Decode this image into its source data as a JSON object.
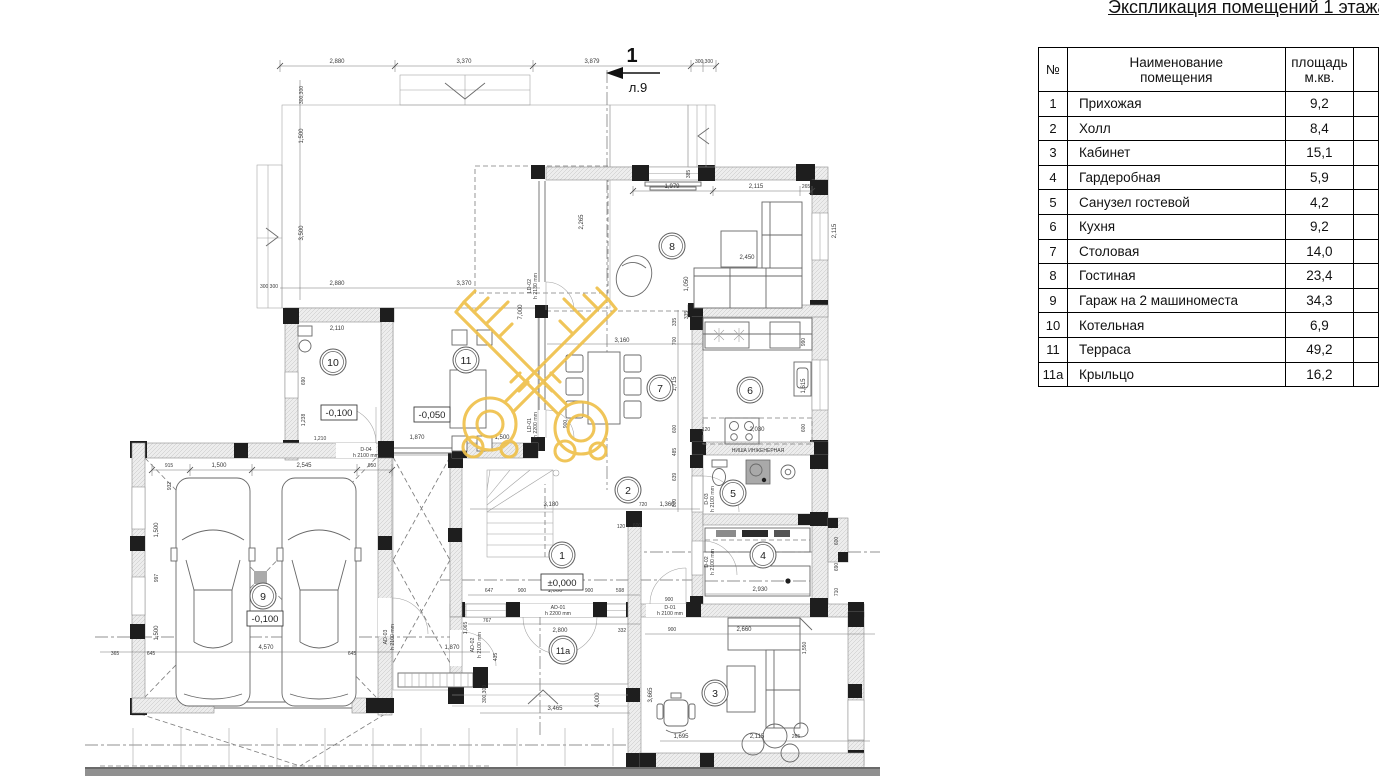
{
  "title": "Экспликация помещений 1 этажа",
  "table": {
    "headers": {
      "num": "№",
      "name1": "Наименование",
      "name2": "помещения",
      "area1": "площадь",
      "area2": "м.кв."
    },
    "rows": [
      {
        "num": "1",
        "name": "Прихожая",
        "area": "9,2"
      },
      {
        "num": "2",
        "name": "Холл",
        "area": "8,4"
      },
      {
        "num": "3",
        "name": "Кабинет",
        "area": "15,1"
      },
      {
        "num": "4",
        "name": "Гардеробная",
        "area": "5,9"
      },
      {
        "num": "5",
        "name": "Санузел гостевой",
        "area": "4,2"
      },
      {
        "num": "6",
        "name": "Кухня",
        "area": "9,2"
      },
      {
        "num": "7",
        "name": "Столовая",
        "area": "14,0"
      },
      {
        "num": "8",
        "name": "Гостиная",
        "area": "23,4"
      },
      {
        "num": "9",
        "name": "Гараж на 2 машиноместа",
        "area": "34,3"
      },
      {
        "num": "10",
        "name": "Котельная",
        "area": "6,9"
      },
      {
        "num": "11",
        "name": "Терраса",
        "area": "49,2"
      },
      {
        "num": "11а",
        "name": "Крыльцо",
        "area": "16,2"
      }
    ]
  },
  "plan": {
    "section_marker": {
      "number": "1",
      "sheet": "л.9"
    },
    "watermark_color": "#EFC14B",
    "rooms": {
      "r1": "1",
      "r2": "2",
      "r3": "3",
      "r4": "4",
      "r5": "5",
      "r6": "6",
      "r7": "7",
      "r8": "8",
      "r9": "9",
      "r10": "10",
      "r11": "11",
      "r11a": "11а"
    },
    "elevations": {
      "entry": "±0,000",
      "terrace": "-0,050",
      "boiler": "-0,100",
      "garage": "-0,100"
    },
    "labels": {
      "niche": "НИША ИНЖЕНЕРНАЯ"
    },
    "doors": {
      "d01": "D-01",
      "d01h": "h 2100 mm",
      "d02": "D-02",
      "d02h": "h 2100 mm",
      "d03": "D-03",
      "d03h": "h 2100 mm",
      "d04": "D-04",
      "d04h": "h 2100 mm",
      "ad01": "AD-01",
      "ad01h": "h 2200 mm",
      "ad02": "AD-02",
      "ad02h": "h 2100 mm",
      "ad03": "AD-03",
      "ad03h": "h 2100 mm",
      "ld01": "LD-01",
      "ld01h": "h 2200 mm",
      "ld02": "LD-02",
      "ld02h": "h 2130 mm"
    },
    "dims": {
      "top1": "2,880",
      "top2": "3,370",
      "top3": "3,879",
      "top4": "300,300",
      "l1": "300,300",
      "l2": "1,500",
      "l3": "3,500",
      "l4": "300 300",
      "ter1": "2,880",
      "ter2": "3,370",
      "ter3": "7,000",
      "ter4": "2,265",
      "ter5": "1,870",
      "ter6": "1,500",
      "liv1": "1,979",
      "liv2": "2,115",
      "liv3": "265",
      "liv4": "2,450",
      "liv5": "1,050",
      "liv6": "2,115",
      "liv7": "335",
      "win1": "385",
      "din1": "3,160",
      "k1": "335",
      "k2": "700",
      "k3": "1,715",
      "k4": "600",
      "k5": "485",
      "k6": "639",
      "k7": "800",
      "kit1": "2,030",
      "kit2": "120",
      "kit3": "990",
      "kit4": "1,615",
      "kit5": "600",
      "hall1": "3,180",
      "hall2": "720",
      "hall3": "1,360",
      "hall4": "600",
      "hall5": "120",
      "hall6": "900",
      "ent1": "647",
      "ent2": "900",
      "ent3": "1,000",
      "ent4": "900",
      "ent5": "598",
      "ent6": "900",
      "por1": "2,800",
      "por2": "332",
      "por3": "767",
      "por4": "1,065",
      "por5": "435",
      "por6": "300,300",
      "por7": "3,465",
      "por8": "4,000",
      "gar1": "915",
      "gar2": "1,500",
      "gar3": "2,545",
      "gar4": "950",
      "gar5": "4,570",
      "gar6": "365",
      "gar7": "645",
      "gar8": "645",
      "gar9": "1,870",
      "gv1": "932",
      "gv2": "1,500",
      "gv3": "997",
      "gv4": "1,500",
      "r10a": "2,110",
      "r10b": "690",
      "r10c": "1,238",
      "r10d": "1,210",
      "r3a": "900",
      "r3b": "2,660",
      "r3c": "1,695",
      "r3d": "2,115",
      "r3e": "265",
      "r3f": "3,665",
      "r3g": "1,550",
      "r4a": "2,930",
      "r4b": "600",
      "r4c": "690",
      "r4d": "710"
    }
  }
}
